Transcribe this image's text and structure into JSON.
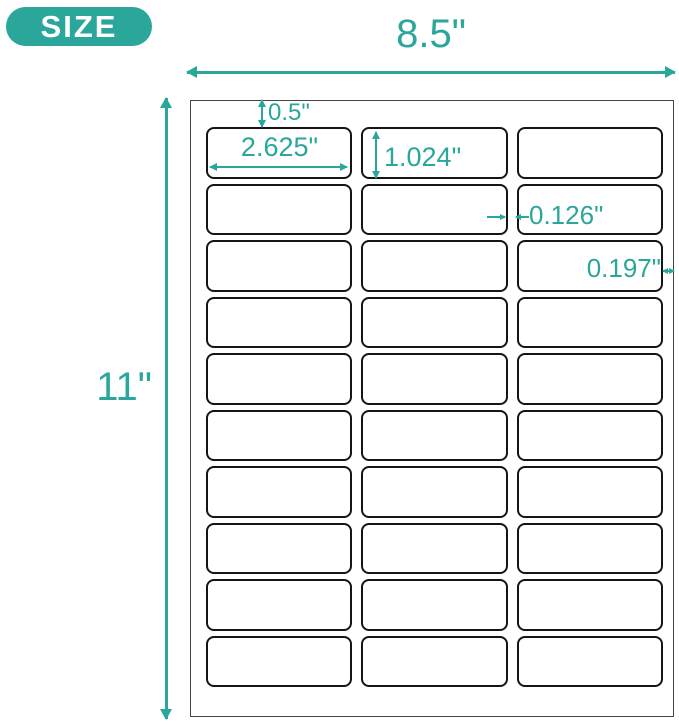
{
  "badge": {
    "label": "SIZE"
  },
  "dimensions": {
    "sheet_width": "8.5\"",
    "sheet_height": "11\"",
    "top_margin": "0.5\"",
    "label_width": "2.625\"",
    "label_height": "1.024\"",
    "column_gap": "0.126\"",
    "right_margin": "0.197\""
  },
  "label_grid": {
    "rows": 10,
    "columns": 3
  },
  "colors": {
    "accent": "#2AA79A",
    "label_border": "#151515",
    "sheet_border": "#464646",
    "badge_text": "#FFFFFF"
  }
}
